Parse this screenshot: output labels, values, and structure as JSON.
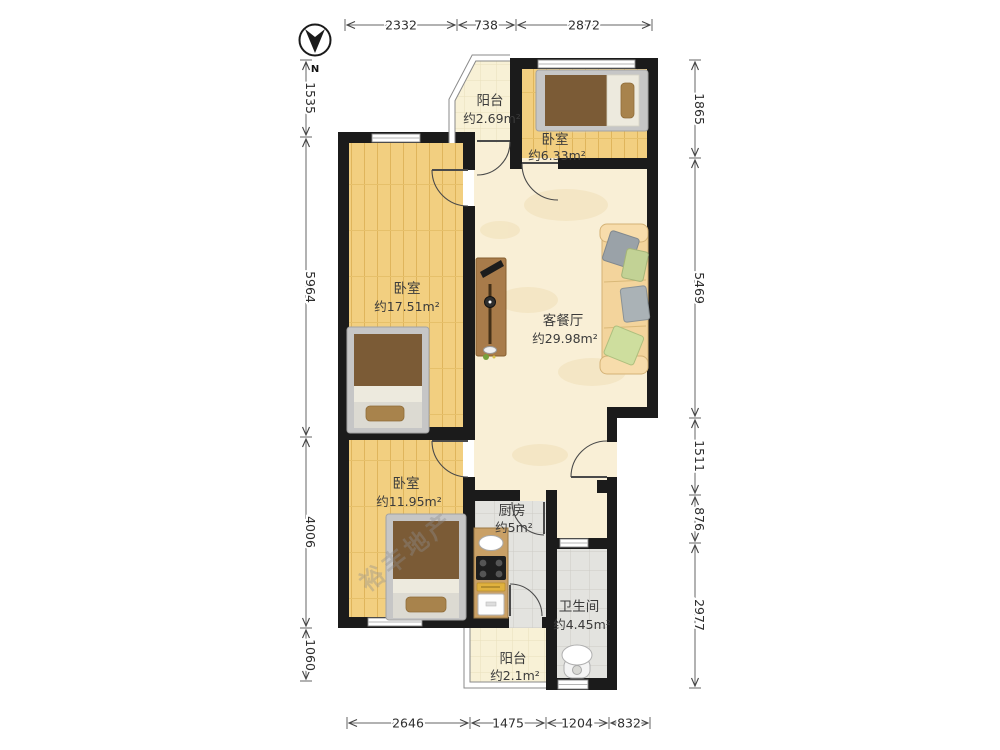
{
  "compass": {
    "label": "N"
  },
  "watermark": "裕丰地产",
  "rooms": {
    "balcony_top": {
      "name": "阳台",
      "area": "约2.69m²"
    },
    "bedroom_top": {
      "name": "卧室",
      "area": "约6.33m²"
    },
    "bedroom_left": {
      "name": "卧室",
      "area": "约17.51m²"
    },
    "living": {
      "name": "客餐厅",
      "area": "约29.98m²"
    },
    "bedroom_bottom": {
      "name": "卧室",
      "area": "约11.95m²"
    },
    "kitchen": {
      "name": "厨房",
      "area": "约5m²"
    },
    "bathroom": {
      "name": "卫生间",
      "area": "约4.45m²"
    },
    "balcony_bottom": {
      "name": "阳台",
      "area": "约2.1m²"
    }
  },
  "dimensions": {
    "top": [
      "2332",
      "738",
      "2872"
    ],
    "bottom": [
      "2646",
      "1475",
      "1204",
      "832"
    ],
    "left": [
      "1535",
      "5964",
      "4006",
      "1060"
    ],
    "right": [
      "1865",
      "5469",
      "1511",
      "876",
      "2977"
    ]
  },
  "colors": {
    "wall": "#1b1b1b",
    "wood_floor": "#f2cf80",
    "living_floor": "#f9efd6",
    "tile_floor": "#e3e3df",
    "balcony_floor": "#f8f1d6",
    "bed_mattress": "#7b5b36",
    "sofa": "#f3d49c",
    "counter": "#c9a066",
    "dimension_text": "#2e2e2e",
    "label_text": "#3b3b3b"
  }
}
